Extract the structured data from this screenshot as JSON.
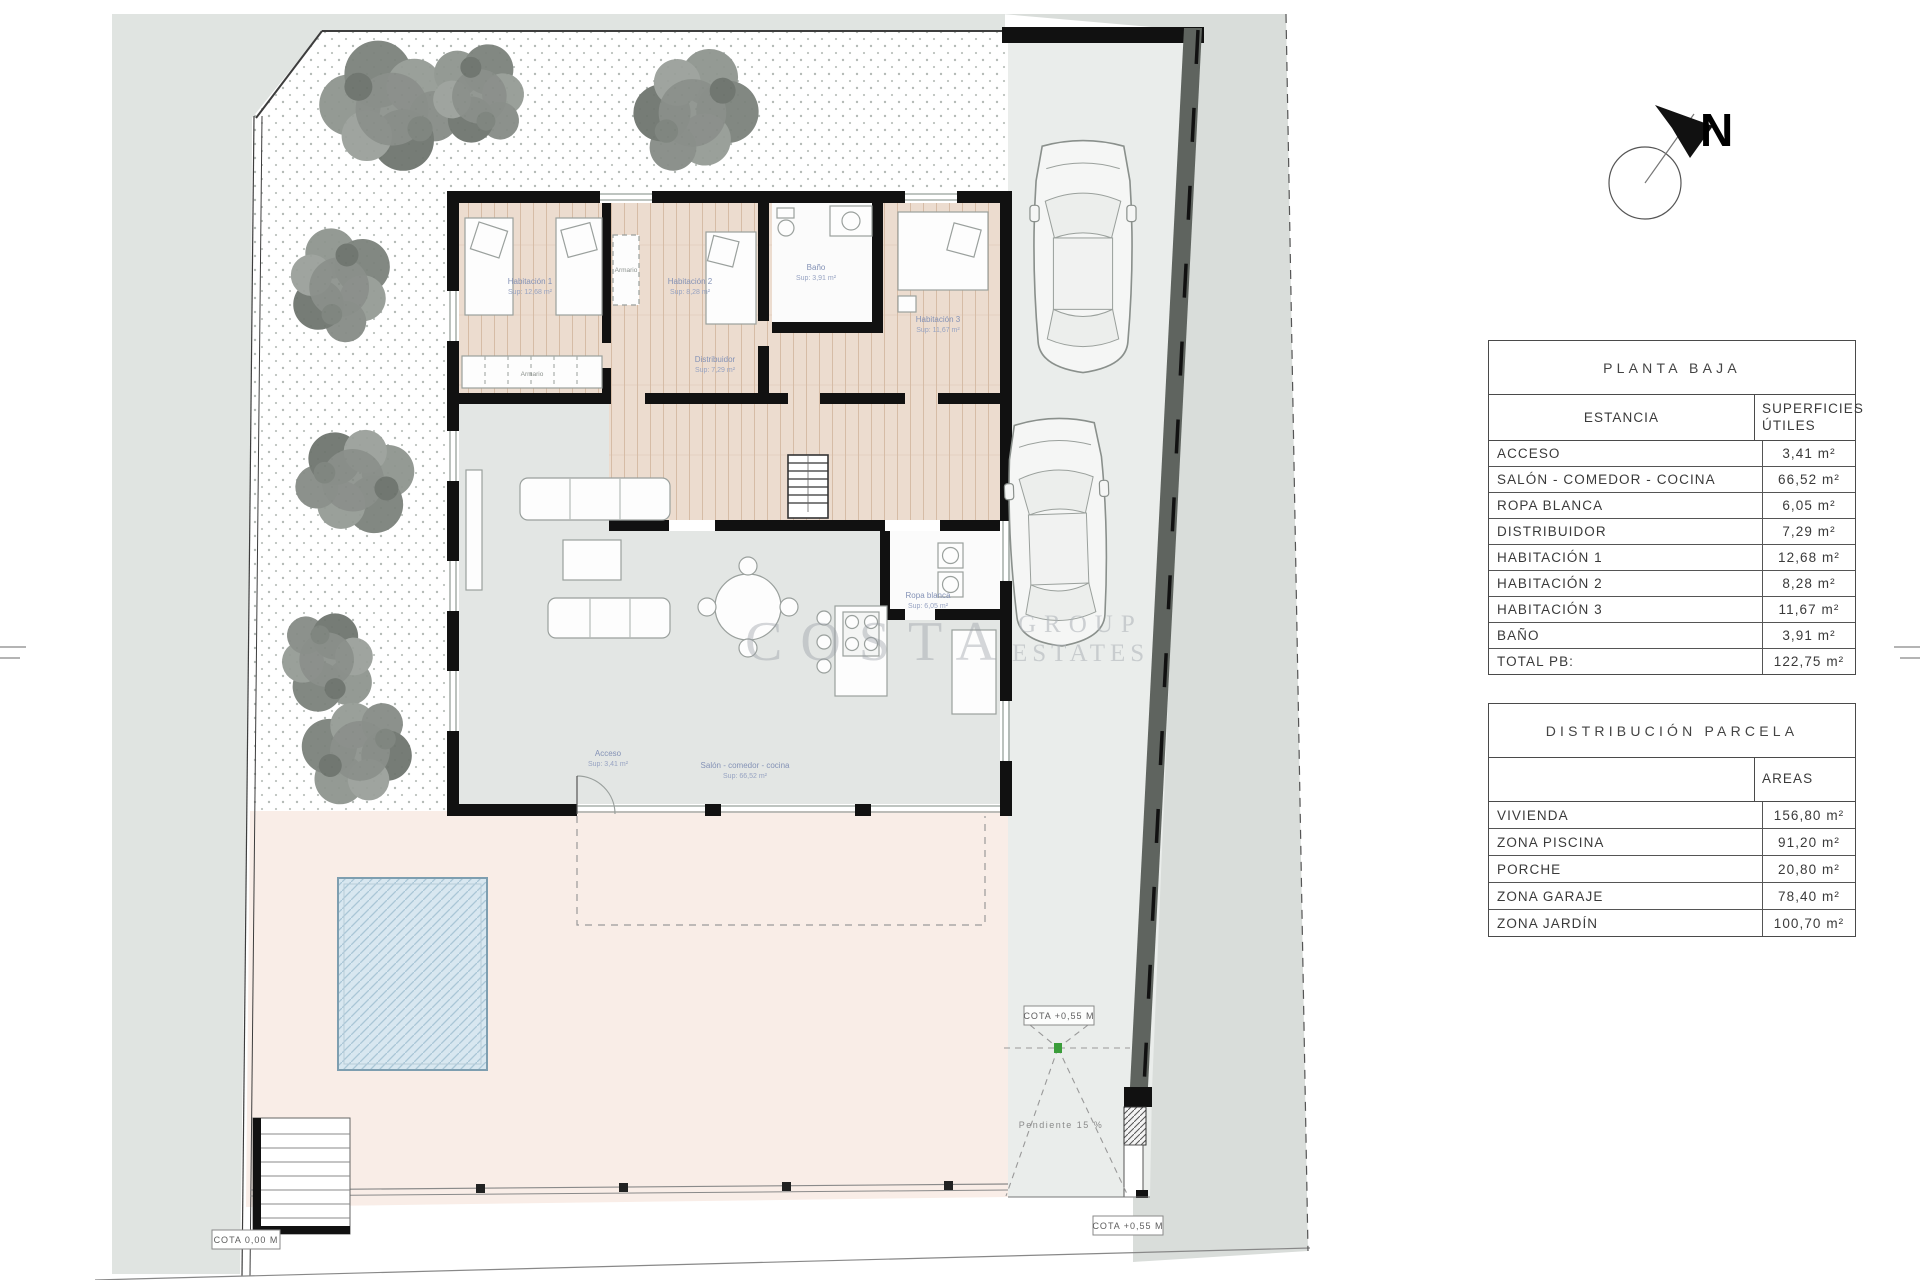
{
  "north": {
    "label": "N"
  },
  "watermark": {
    "big": "COSTA",
    "line1": "GROUP",
    "line2": "ESTATES"
  },
  "tables": {
    "planta_baja": {
      "title": "PLANTA BAJA",
      "col1": "ESTANCIA",
      "col2": "SUPERFICIES ÚTILES",
      "rows": [
        {
          "label": "ACCESO",
          "value": "3,41 m²"
        },
        {
          "label": "SALÓN - COMEDOR - COCINA",
          "value": "66,52 m²"
        },
        {
          "label": "ROPA BLANCA",
          "value": "6,05 m²"
        },
        {
          "label": "DISTRIBUIDOR",
          "value": "7,29 m²"
        },
        {
          "label": "HABITACIÓN 1",
          "value": "12,68 m²"
        },
        {
          "label": "HABITACIÓN 2",
          "value": "8,28 m²"
        },
        {
          "label": "HABITACIÓN 3",
          "value": "11,67 m²"
        },
        {
          "label": "BAÑO",
          "value": "3,91 m²"
        },
        {
          "label": "TOTAL PB:",
          "value": "122,75 m²"
        }
      ]
    },
    "parcela": {
      "title": "DISTRIBUCIÓN PARCELA",
      "col1": "",
      "col2": "AREAS",
      "rows": [
        {
          "label": "VIVIENDA",
          "value": "156,80 m²"
        },
        {
          "label": "ZONA PISCINA",
          "value": "91,20 m²"
        },
        {
          "label": "PORCHE",
          "value": "20,80 m²"
        },
        {
          "label": "ZONA GARAJE",
          "value": "78,40 m²"
        },
        {
          "label": "ZONA JARDÍN",
          "value": "100,70 m²"
        }
      ]
    }
  },
  "plan": {
    "rooms": {
      "hab1": {
        "name": "Habitación 1",
        "sup": "Sup: 12,68 m²"
      },
      "hab2": {
        "name": "Habitación 2",
        "sup": "Sup: 8,28 m²"
      },
      "hab3": {
        "name": "Habitación 3",
        "sup": "Sup: 11,67 m²"
      },
      "bano": {
        "name": "Baño",
        "sup": "Sup: 3,91 m²"
      },
      "distribuidor": {
        "name": "Distribuidor",
        "sup": "Sup: 7,29 m²"
      },
      "ropa": {
        "name": "Ropa blanca",
        "sup": "Sup: 6,05 m²"
      },
      "salon": {
        "name": "Salón - comedor - cocina",
        "sup": "Sup: 66,52 m²"
      },
      "acceso": {
        "name": "Acceso",
        "sup": "Sup: 3,41 m²"
      }
    },
    "annotations": {
      "cota0": "COTA 0,00 M",
      "cota55": "COTA +0,55 M",
      "pendiente": "Pendiente 15 %",
      "armario": "Armario"
    }
  }
}
